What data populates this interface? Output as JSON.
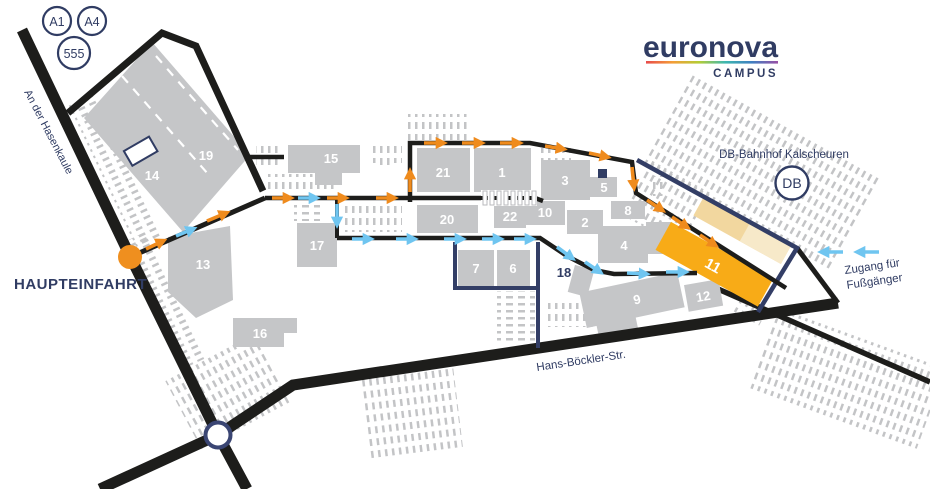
{
  "road_badges": {
    "a1": "A1",
    "a4": "A4",
    "b555": "555"
  },
  "logo": {
    "brand": "euronova",
    "sub": "CAMPUS"
  },
  "streets": {
    "hasenkaule": "An der Hasenkaule",
    "hans_boeckler": "Hans-Böckler-Str."
  },
  "poi": {
    "main_entrance": "HAUPTEINFAHRT",
    "db_station": "DB-Bahnhof Kalscheuren",
    "db_badge": "DB",
    "pedestrian_l1": "Zugang für",
    "pedestrian_l2": "Fußgänger",
    "outdoor_area": "18"
  },
  "buildings": {
    "b1": "1",
    "b2": "2",
    "b3": "3",
    "b4": "4",
    "b5": "5",
    "b6": "6",
    "b7": "7",
    "b8": "8",
    "b9": "9",
    "b10": "10",
    "b11": "11",
    "b12": "12",
    "b13": "13",
    "b14": "14",
    "b15": "15",
    "b16": "16",
    "b17": "17",
    "b19": "19",
    "b20": "20",
    "b21": "21",
    "b22": "22"
  },
  "colors": {
    "navy": "#303c63",
    "road_black": "#1d1d1b",
    "building_gray": "#c5c6c8",
    "hatch_gray": "#c3c4c6",
    "route_orange": "#ef8b1d",
    "route_blue": "#6fc5f0",
    "building_orange": "#f8ab17",
    "platform_beige": "#f2d79f",
    "logo_gradient": [
      "#e84b4b",
      "#f49d37",
      "#b5cc35",
      "#3eb7b0",
      "#3f7fc1",
      "#9950a5"
    ]
  }
}
